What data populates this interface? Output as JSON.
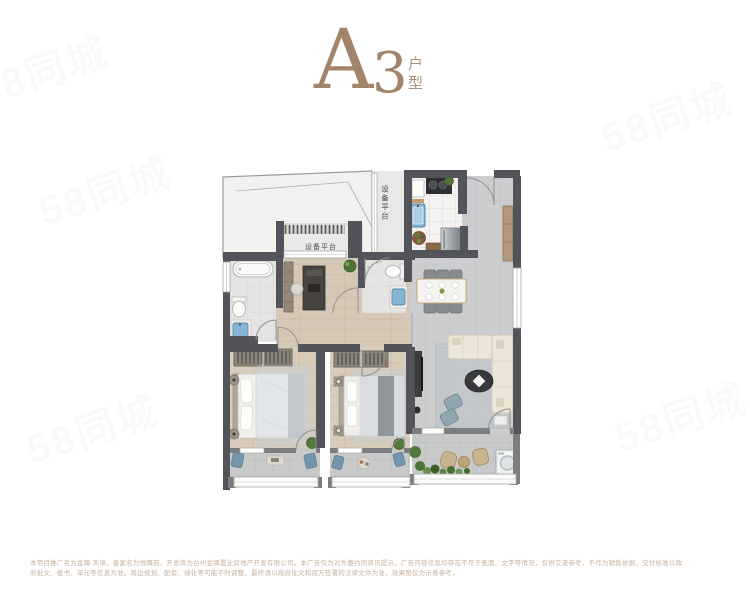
{
  "header": {
    "letter": "A",
    "number": "3",
    "suffix": "户型",
    "accent_color": "#a1846a"
  },
  "floorplan": {
    "labels": {
      "platform_vertical": "设备平台",
      "platform_horizontal": "设备平台"
    },
    "colors": {
      "wall": "#53545a",
      "tile_floor": "#cbcdcf",
      "wood_floor": "#d5c8b6",
      "bath_floor": "#e5e4e2",
      "balcony_floor": "#c8c9c9",
      "sink_blue": "#85b6d6",
      "plant_green": "#55793c",
      "cabinet_brown": "#b3977a",
      "sofa_cream": "#ece6d9"
    }
  },
  "watermark": {
    "text": "58同城"
  },
  "disclaimer": {
    "line1": "本项目推广名为金隅·天境，备案名为悦隅苑，开发商为台州金隅置业房地产开发有限公司。本广告仅为对外邀约的资讯提示，广告内容信息均存在不尽于画面、文字等情况，仅供交流参考，不作为销售依据，交付标准以政",
    "line2": "府批文、楼书、单元等信息为准。周边规划、配套、绿化等可能不时调整，最终请以政府批文和双方签署的法律文件为准，效果图仅为示意参考。"
  }
}
